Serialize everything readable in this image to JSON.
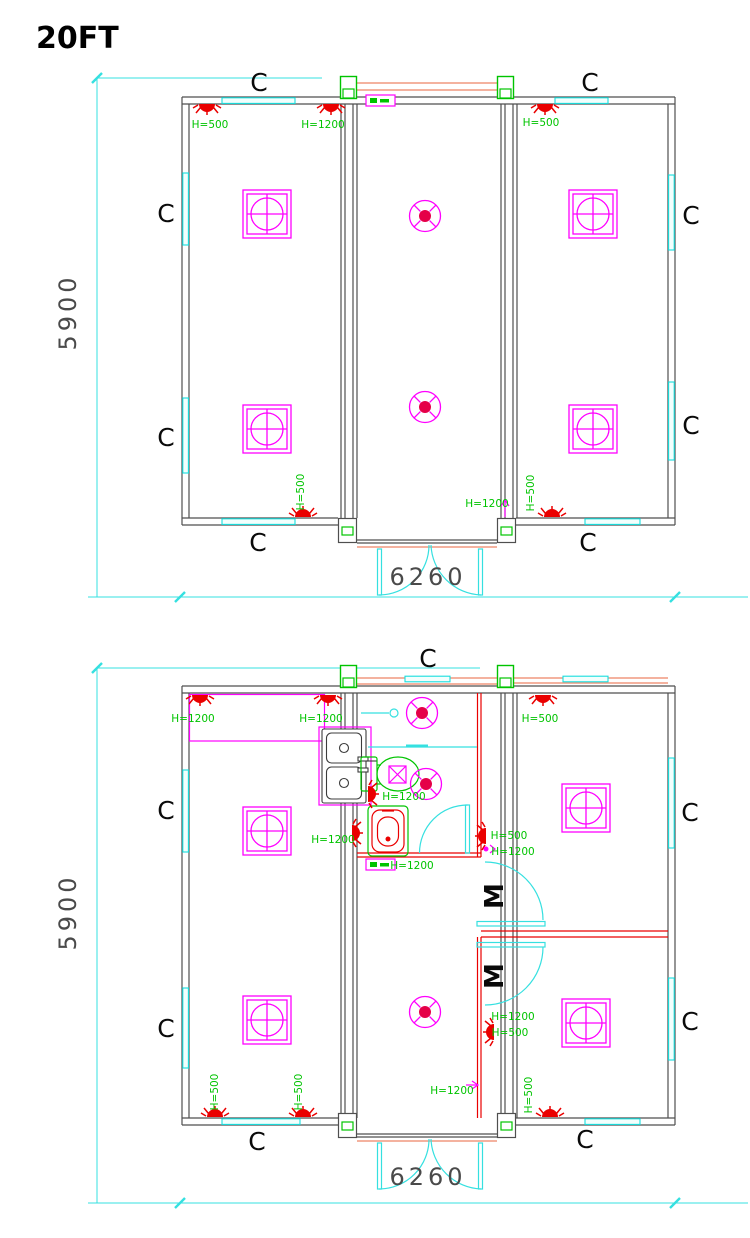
{
  "title": "20FT",
  "labels": {
    "window": "C",
    "door": "M",
    "h500": "H=500",
    "h1200": "H=1200"
  },
  "dimensions": {
    "width": "6260",
    "height": "5900"
  },
  "colors": {
    "bg": "#ffffff",
    "wall": "#4f4f4f",
    "glass": "#18dede",
    "dim": "#35e0e0",
    "magenta": "#ff00ff",
    "red": "#ea0000",
    "green": "#00c400",
    "beam": "#ee8466",
    "fan_center": "#e50048",
    "dim_text": "#4a4a4a",
    "text": "#0a0a0a"
  }
}
